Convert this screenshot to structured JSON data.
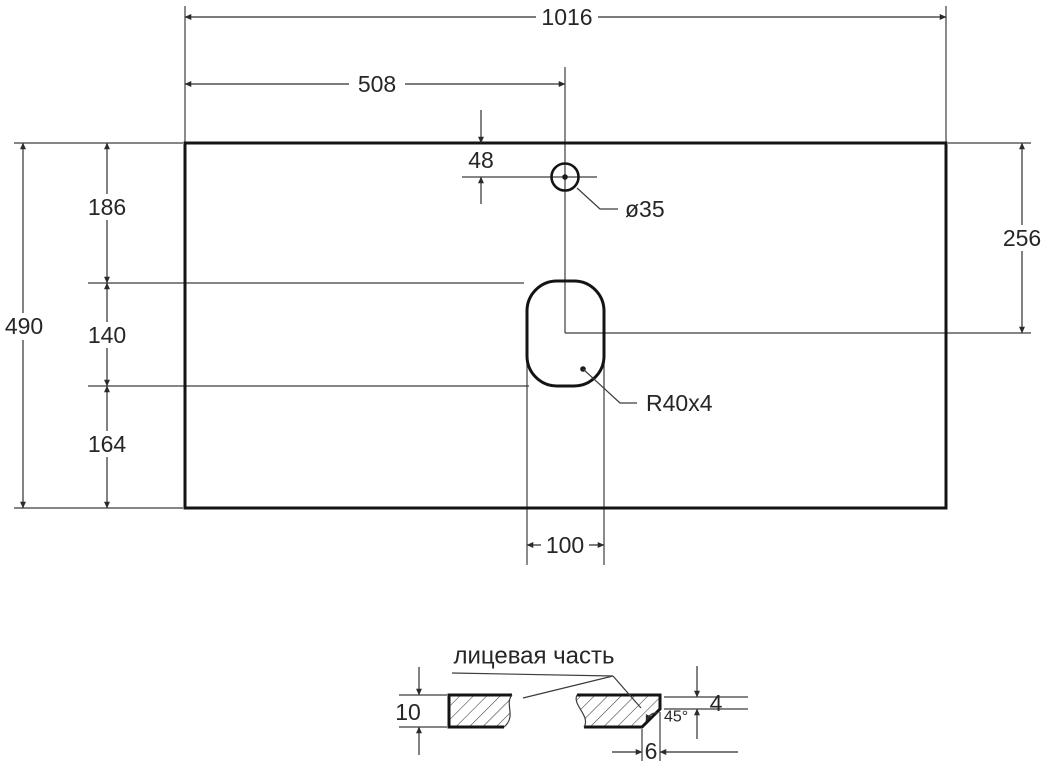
{
  "top_view": {
    "total_width": "1016",
    "to_hole_center": "508",
    "hole_top_offset": "48",
    "hole_diameter": "ø35",
    "total_height": "490",
    "seg_top_to_cutout": "186",
    "seg_cutout_height": "140",
    "seg_cutout_to_bottom": "164",
    "right_top_to_center": "256",
    "cutout_width": "100",
    "cutout_corner_label": "R40x4"
  },
  "section_view": {
    "face_label": "лицевая часть",
    "thickness": "10",
    "edge_height": "4",
    "chamfer_angle": "45°",
    "chamfer_width": "6"
  },
  "colors": {
    "background": "#ffffff",
    "thin_line": "#3c3c3c",
    "outline": "#141414",
    "text": "#262626"
  }
}
